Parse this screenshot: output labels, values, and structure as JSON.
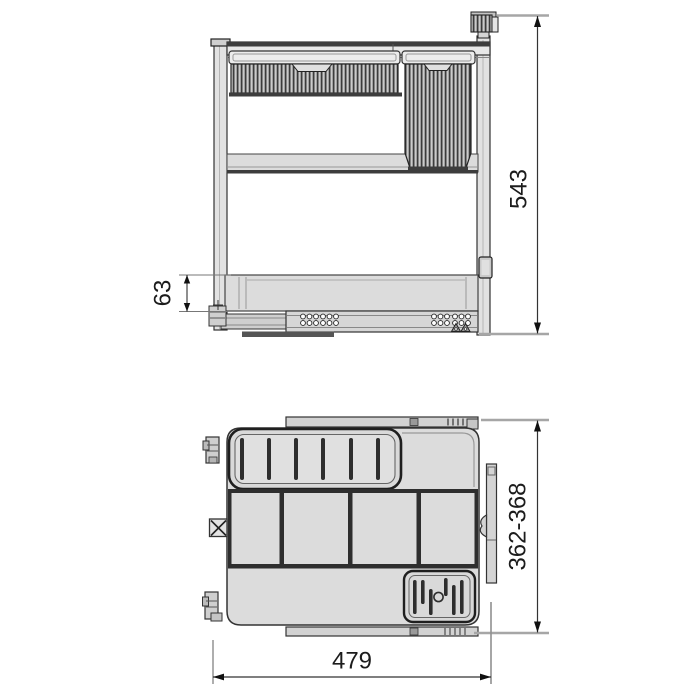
{
  "figure": {
    "type": "technical-dimension-drawing",
    "views": [
      {
        "name": "front-elevation",
        "dimension_labels": [
          {
            "id": "total-height",
            "text": "543"
          },
          {
            "id": "drawer-slide-height",
            "text": "63"
          }
        ]
      },
      {
        "name": "top-plan",
        "dimension_labels": [
          {
            "id": "depth-range",
            "text": "362-368"
          },
          {
            "id": "overall-width",
            "text": "479"
          }
        ]
      }
    ],
    "colors": {
      "background": "#ffffff",
      "part_fill": "#dcdcdc",
      "part_fill_light": "#ececec",
      "outline": "#2e2e2e",
      "hatch": "#3c3c3c",
      "extension_line": "#a6a6a6",
      "dimension_line": "#333333",
      "label_text": "#1c1c1c"
    }
  }
}
